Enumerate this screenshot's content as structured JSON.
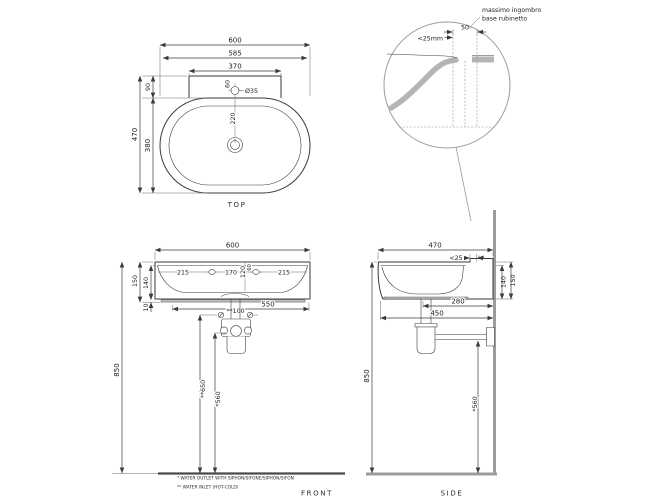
{
  "colors": {
    "line": "#3a3a3a",
    "wall_gray": "#9c9c9c",
    "section_gray": "#b5b5b5"
  },
  "detail_view": {
    "note_line1": "massimo ingombro",
    "note_line2": "base rubinetto",
    "dim_max_tap": "<25mm",
    "dim_50": "50"
  },
  "top_view": {
    "label": "TOP",
    "dim_width": "600",
    "dim_width_inner": "585",
    "dim_deck_width": "370",
    "dim_depth": "470",
    "dim_deck_depth": "90",
    "dim_bowl_depth": "380",
    "dim_hole_offset": "60",
    "dim_hole_dia": "Ø35",
    "dim_drain_offset": "220"
  },
  "front_view": {
    "label": "FRONT",
    "dim_width": "600",
    "dim_hole_left": "215",
    "dim_hole_spacing": "170",
    "dim_hole_right": "215",
    "dim_120": "120",
    "dim_60": "60",
    "dim_height": "150",
    "dim_height_inner": "140",
    "dim_plinth": "10",
    "dim_550": "550",
    "dim_850": "850",
    "dim_inlet_spacing": "**100",
    "dim_inlet_height": "**650",
    "dim_outlet_height": "*560"
  },
  "side_view": {
    "label": "SIDE",
    "dim_depth": "470",
    "dim_rear_gap": "<25",
    "dim_height_inner": "140",
    "dim_height": "150",
    "dim_280": "280",
    "dim_450": "450",
    "dim_850": "850",
    "dim_outlet_height": "*560"
  },
  "footnotes": {
    "outlet": "* WATER OUTLET WITH SIPHON/SIFONE/SIPHON/SIFON",
    "inlet": "** WATER INLET (HOT-COLD)"
  }
}
